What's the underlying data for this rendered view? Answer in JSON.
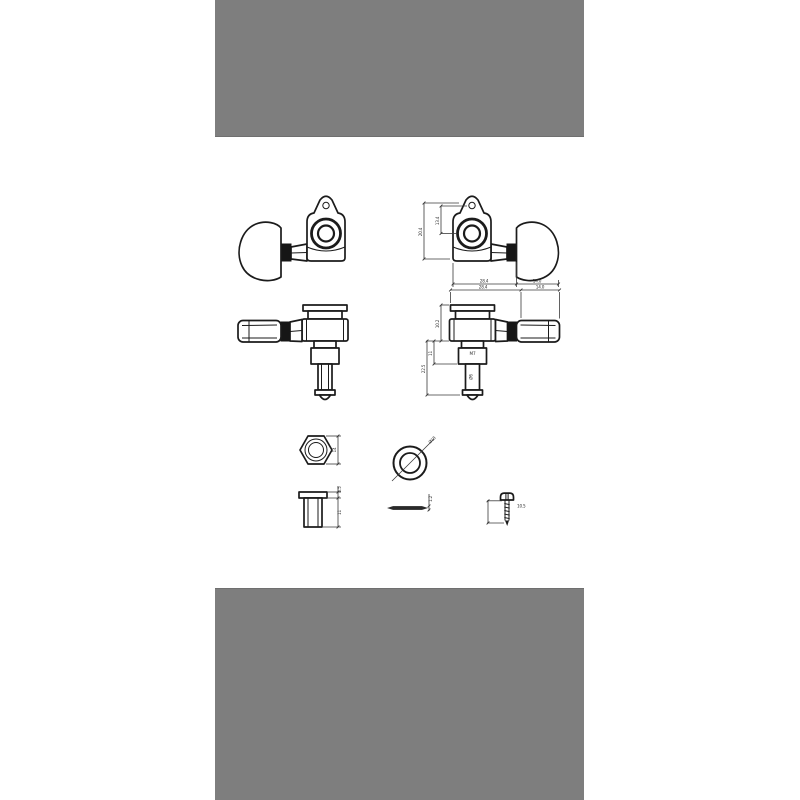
{
  "canvas": {
    "background": "#ffffff",
    "letterbox_color": "#7e7e7e",
    "line_color": "#1b1b1b",
    "dim_color": "#3a3a3a"
  },
  "dimensions": {
    "side_view": {
      "overall_height": "20.4",
      "hole_to_center": "13.4",
      "body_width": "28.4",
      "knob_length": "14.0"
    },
    "front_view": {
      "body_width": "28.4",
      "knob_length": "14.0",
      "cap_to_base": "10.2",
      "bushing_depth": "11",
      "overall_length": "22.5",
      "thread_label": "M7",
      "post_dia": "Ø6"
    },
    "nut": {
      "width": "14"
    },
    "washer": {
      "diameter": "Ø18",
      "thickness": "1.2"
    },
    "bushing": {
      "flange": "1.5",
      "length": "11"
    },
    "screw": {
      "length": "10.5"
    }
  }
}
